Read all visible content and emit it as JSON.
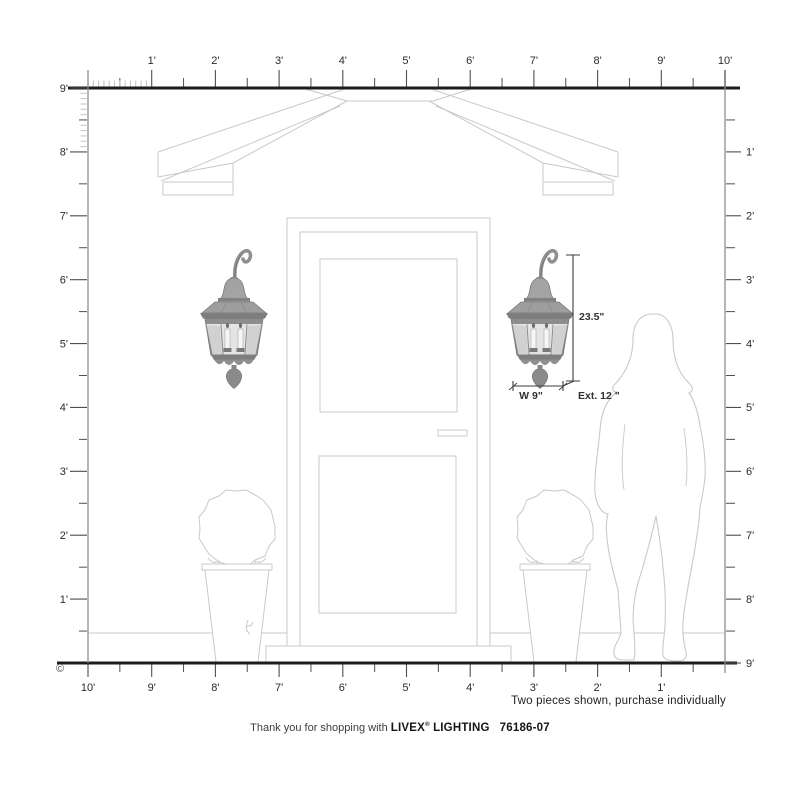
{
  "rulers": {
    "top": {
      "labels": [
        "1'",
        "2'",
        "3'",
        "4'",
        "5'",
        "6'",
        "7'",
        "8'",
        "9'",
        "10'"
      ]
    },
    "left": {
      "labels": [
        "9'",
        "8'",
        "7'",
        "6'",
        "5'",
        "4'",
        "3'",
        "2'",
        "1'"
      ]
    },
    "right": {
      "labels": [
        "1'",
        "2'",
        "3'",
        "4'",
        "5'",
        "6'",
        "7'",
        "8'",
        "9'"
      ]
    },
    "bottom": {
      "labels": [
        "10'",
        "9'",
        "8'",
        "7'",
        "6'",
        "5'",
        "4'",
        "3'",
        "2'",
        "1'"
      ]
    }
  },
  "dimensions": {
    "height": "23.5\"",
    "width": "W 9\"",
    "extension": "Ext. 12 \""
  },
  "note": "Two pieces shown, purchase individually",
  "footer": {
    "prefix": "Thank you for shopping with",
    "brand": "LIVEX",
    "reg": "®",
    "brand2": "LIGHTING",
    "sku": "76186-07"
  },
  "copyright": "©",
  "colors": {
    "ruler_line": "#1c1c1c",
    "ruler_gray": "#8f8f8f",
    "tick": "#4f4f4f",
    "inch_tick": "#c2c2c2",
    "drawing_line": "#c9c9c9",
    "dimension": "#3a3a3a",
    "lantern_mid": "#9a9a9a",
    "lantern_dark": "#6e6e6e",
    "glass": "#e4e4e4",
    "background": "#ffffff"
  }
}
